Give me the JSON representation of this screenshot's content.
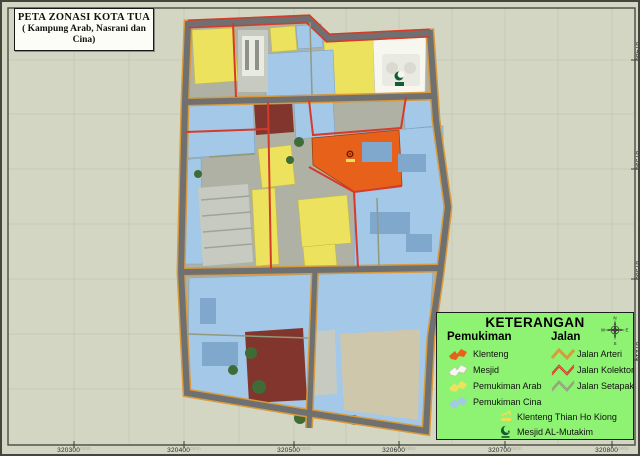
{
  "title_box": {
    "line1": "PETA ZONASI KOTA TUA",
    "line2": "( Kampung Arab, Nasrani dan Cina)"
  },
  "legend": {
    "title": "KETERANGAN",
    "pemukiman_heading": "Pemukiman",
    "jalan_heading": "Jalan",
    "pemukiman": [
      {
        "label": "Klenteng"
      },
      {
        "label": "Mesjid"
      },
      {
        "label": "Pemukiman Arab"
      },
      {
        "label": "Pemukiman Cina"
      }
    ],
    "jalan": [
      {
        "label": "Jalan Arteri"
      },
      {
        "label": "Jalan Kolektor"
      },
      {
        "label": "Jalan Setapak"
      }
    ],
    "symbols": [
      {
        "label": "Klenteng Thian Ho Kiong"
      },
      {
        "label": "Mesjid AL-Mutakim"
      }
    ],
    "compass": {
      "n": "N",
      "e": "E",
      "s": "S",
      "w": "W"
    }
  },
  "axes": {
    "bottom": [
      "320300",
      "320400",
      "320500",
      "320600",
      "320700",
      "320800"
    ],
    "right": [
      "87480",
      "87390",
      "87300",
      "87210"
    ],
    "suffix": "0000"
  },
  "colors": {
    "page_bg": "#D3D6C2",
    "legend_bg": "#8EF272",
    "klenteng": "#E8611A",
    "mesjid": "#F7F7F0",
    "arab": "#EDE25E",
    "cina": "#A3C8E8",
    "cina_dark": "#7FA8CC",
    "arteri": "#D89A3B",
    "kolektor": "#D63A2A",
    "setapak": "#93997C",
    "road": "#6F7072",
    "photo": "#AEB1A3",
    "maroon": "#82352C",
    "building_gray": "#C7CAC1",
    "building_white": "#E9EAE2",
    "beige": "#CEC7AC",
    "tree": "#3F6B37",
    "crescent": "#145A32",
    "temple_yellow": "#EDDF55",
    "grid": "#C3C6B3",
    "neatline": "#4A4A45"
  }
}
